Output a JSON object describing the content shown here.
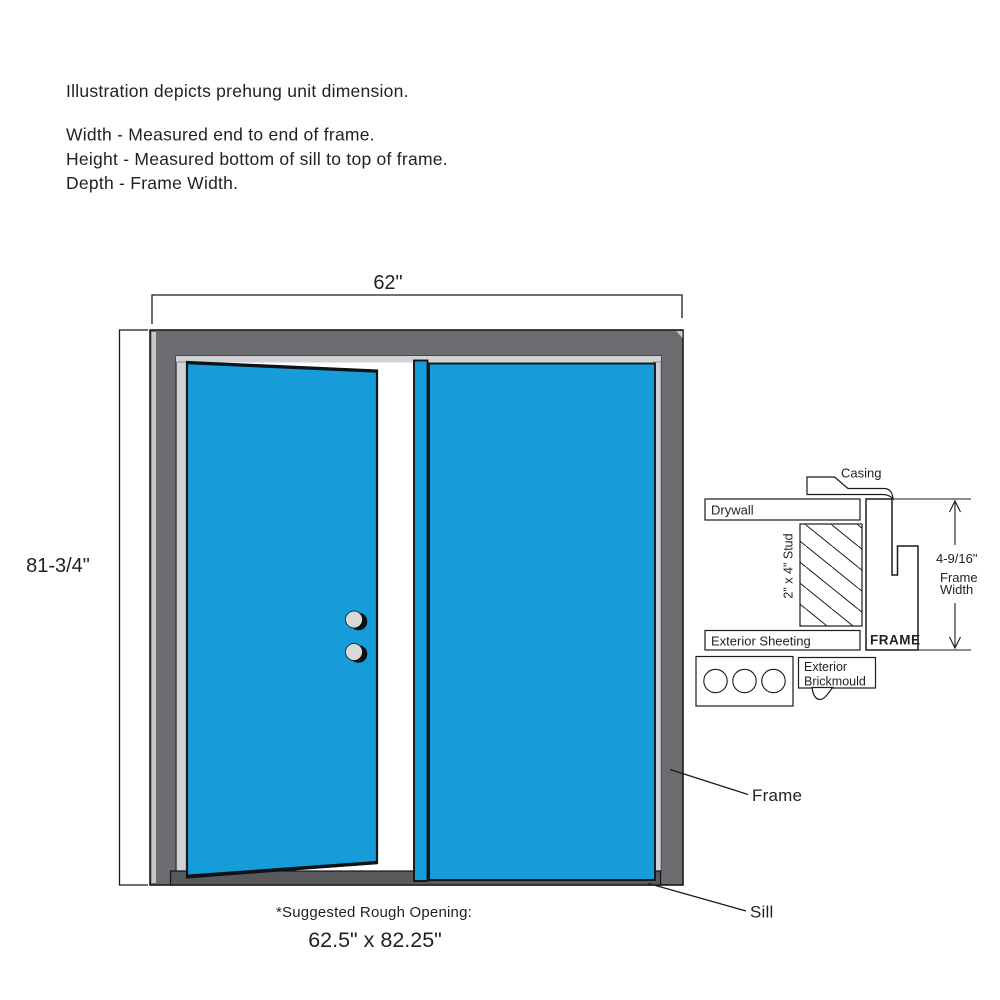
{
  "notes": {
    "line1": "Illustration depicts prehung unit dimension.",
    "line2": "Width - Measured end to end of frame.",
    "line3": "Height - Measured bottom of sill to top of frame.",
    "line4": "Depth - Frame Width."
  },
  "dims": {
    "width_label": "62\"",
    "height_label": "81-3/4\"",
    "rough_opening_caption": "*Suggested Rough Opening:",
    "rough_opening_value": "62.5\" x 82.25\"",
    "frame_width_value": "4-9/16\"",
    "frame_width_word1": "Frame",
    "frame_width_word2": "Width"
  },
  "callouts": {
    "frame": "Frame",
    "sill": "Sill"
  },
  "detail": {
    "casing": "Casing",
    "drywall": "Drywall",
    "stud": "2\" x 4\" Stud",
    "exterior_sheeting": "Exterior Sheeting",
    "frame": "FRAME",
    "brickmould_line1": "Exterior",
    "brickmould_line2": "Brickmould"
  },
  "colors": {
    "door_blue": "#169CD8",
    "frame_gray": "#6C6D70",
    "jamb_light_gray": "#D1D2D4",
    "sill_gray": "#58595B",
    "knob_gray": "#D8D9DA",
    "bevel_gray": "#C7C8CA",
    "ink": "#231F20",
    "background": "#FFFFFF"
  }
}
